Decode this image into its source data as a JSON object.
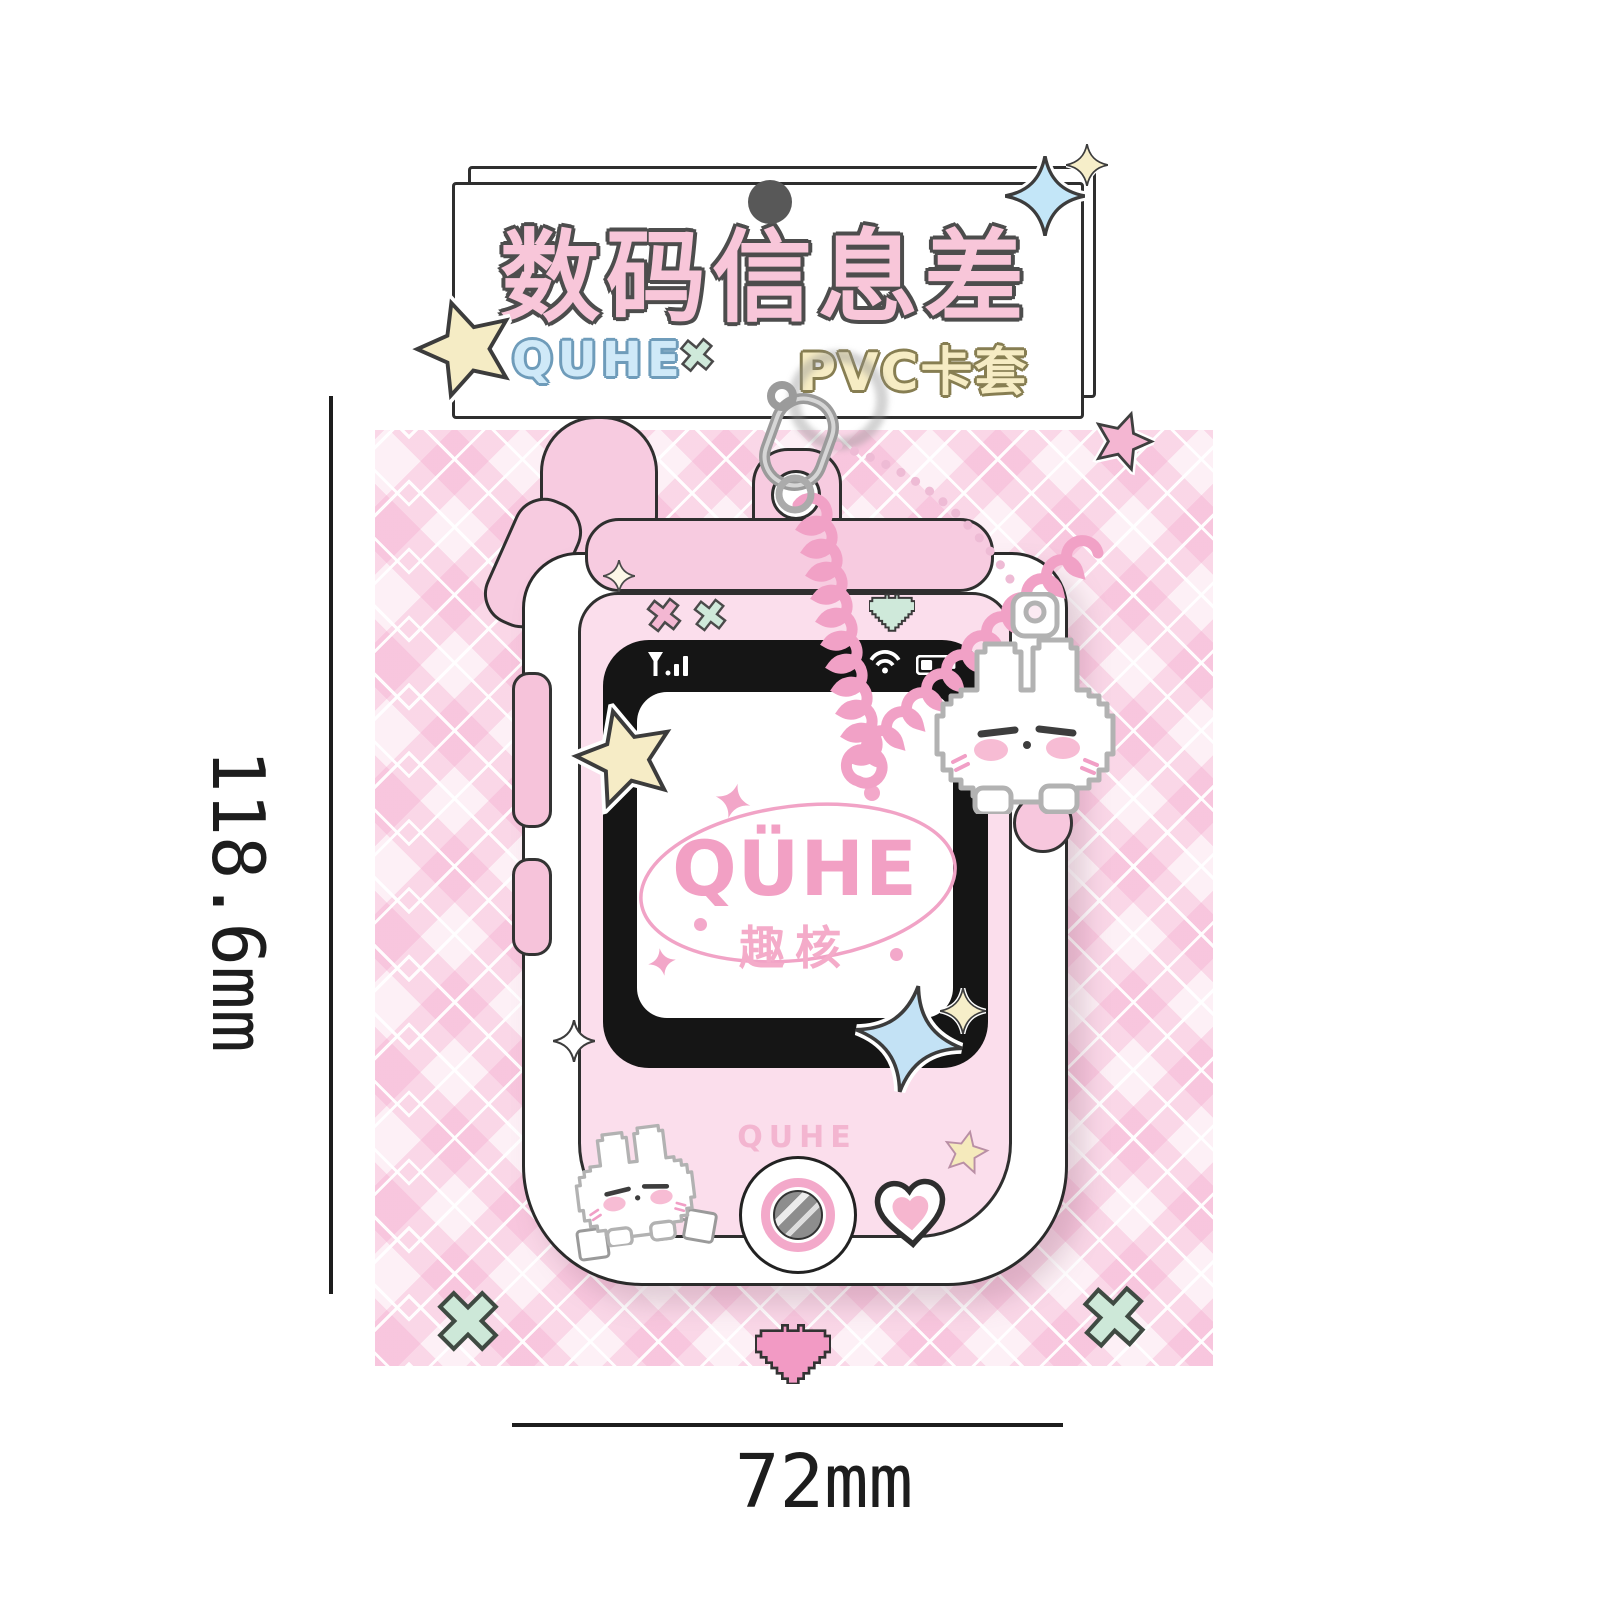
{
  "banner": {
    "title": "数码信息差",
    "brand": "QUHE",
    "product_type": "PVC卡套"
  },
  "screen": {
    "logo": "QÜHE",
    "subtitle": "趣核"
  },
  "phone": {
    "brand_label": "QUHE"
  },
  "dimensions": {
    "height": "118.6mm",
    "width": "72mm"
  },
  "colors": {
    "title_pink": "#f8c6d9",
    "brand_blue": "#cfe9f8",
    "product_cream": "#f6ecc4",
    "logo_pink": "#f2a0c4",
    "face_pink": "#fbdeec",
    "coil_pink": "#f1a1c6",
    "mint": "#cfe9da",
    "argyle_pink": "#f6c0da",
    "bezel_black": "#151515"
  },
  "icons": {
    "status_bar": [
      "signal-icon",
      "wifi-icon",
      "battery-icon"
    ],
    "decor": [
      "star-icon",
      "sparkle-icon",
      "cross-icon",
      "pixel-heart-icon",
      "heart-icon",
      "bunny-charm",
      "carabiner-icon",
      "camera-button"
    ]
  }
}
